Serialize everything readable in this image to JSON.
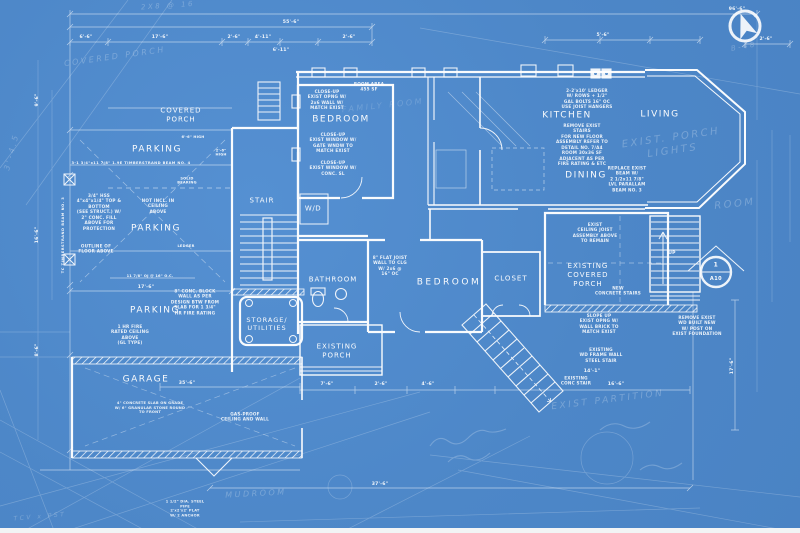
{
  "colors": {
    "background": "#4d87c8",
    "ink": "#ffffff"
  },
  "rooms": {
    "covered_porch": "COVERED\nPORCH",
    "parking_upper": "PARKING",
    "parking_middle": "PARKING",
    "parking_lower": "PARKING",
    "stair": "STAIR",
    "washer_dryer": "W/D",
    "bedroom_upper": "BEDROOM",
    "kitchen": "KITCHEN",
    "living": "LIVING",
    "dining": "DINING",
    "bathroom": "BATHROOM",
    "bedroom_main": "BEDROOM",
    "closet": "CLOSET",
    "existing_covered_porch": "EXISTING\nCOVERED\nPORCH",
    "existing_porch": "EXISTING\nPORCH",
    "storage_utilities": "STORAGE/\nUTILITIES",
    "garage": "GARAGE",
    "stair_up": "UP"
  },
  "callout": {
    "sheet_number": "1",
    "detail_ref": "A10"
  },
  "dims": {
    "top_total": "96'-6\"",
    "top_span": "55'-6\"",
    "seg_a": "6'-6\"",
    "seg_b": "17'-6\"",
    "seg_c": "2'-6\"",
    "seg_d": "4'-11\"",
    "seg_e": "6'-11\"",
    "seg_f": "2'-6\"",
    "right_a": "5'-6\"",
    "right_b": "2'-6\"",
    "left_a": "9'-6\"",
    "left_b": "16'-6\"",
    "left_c": "8'-6\"",
    "parking_width": "17'-6\"",
    "joist_note": "11 7/8\" OJ @ 16\" O.C.",
    "ledger": "LEDGER",
    "height_a": "6'-6\" HIGH",
    "height_b": "2'-6\"\nHIGH",
    "solid_bearing": "SOLID\nBEARING",
    "beam_note": "3-1 3/4\"x11 7/8\" 1.9E TIMBERSTRAND BEAM NO. 4",
    "beam_vert": "TC TIMBERSTRAND BEAM NO. 3",
    "garage_width": "35'-6\"",
    "porch_a": "7'-6\"",
    "porch_b": "2'-6\"",
    "porch_c": "4'-6\"",
    "south_a": "14'-1\"",
    "south_b": "16'-6\"",
    "east_height": "17'-6\"",
    "bottom_total": "37'-6\""
  },
  "notes": {
    "bedroom_opening": "CLOSE-UP\nEXIST OPNG W/\n2x6 WALL W/\nMATCH EXIST",
    "room_area": "ROOM AREA\n455 SF",
    "bedroom_window_a": "CLOSE-UP\nEXIST WINDOW W/\nGATE WNDW TO\nMATCH EXIST",
    "bedroom_window_b": "CLOSE-UP\nEXIST WINDOW W/\nCONC. SL",
    "ledger_detail": "2-2'x10' LEDGER\nW/ ROWS + 1/2\"\nGAL BOLTS 16\" OC\nUSE JOIST HANGERS",
    "stair_removal": "REMOVE EXIST\nSTAIRS\nFOR NEW FLOOR\nASSEMBLY REFER TO\nDETAIL NO. 7/A4\nROOM 30x36 SF\nADJACENT AS PER\nFIRE RATING & ETC",
    "beam_replace": "REPLACE EXIST\nBEAM W/\n2 1/2x11 7/8\"\nLVL PARALLAM\nBEAM NO. 3",
    "hss_column": "3/4\" HSS\n4\"x4\"x1/4\" TOP &\nBOTTOM\n(SEE STRUCT.) W/\n2\" CONC. FILL\nABOVE FOR\nPROTECTION",
    "floor_outline": "OUTLINE OF\nFLOOR ABOVE",
    "ceiling_gap": "NOT INCL. IN\nCEILING\nABOVE",
    "fire_ceiling": "1 HR FIRE\nRATED CEILING\nABOVE\n(GL TYPE)",
    "block_wall": "8\" CONC. BLOCK\nWALL AS PER\nDESIGN BTW FROM\nSLAB FOR 1 3/4\"\nHR FIRE RATING",
    "garage_slab": "4\" CONCRETE SLAB ON GRADE\nW/ 6\" GRANULAR STONE ROUND\nTO FRONT",
    "gasproof": "GAS-PROOF\nCEILING AND WALL",
    "steel_pipe": "1 1/2\" DIA. STEEL\nPIPE\n2'x2'x2' PLAT\nW/ 2 ANCHOR",
    "ceiling_joist": "EXIST\nCEILING JOIST\nASSEMBLY ABOVE\nTO REMAIN",
    "concrete_stairs": "NEW\nCONCRETE STAIRS",
    "slope_up": "SLOPE UP\nEXIST OPNG W/\nWALL BRICK TO\nMATCH EXIST",
    "porch_post": "REMOVE EXIST\nWD BUILT NEW\nW/ POST ON\nEXIST FOUNDATION",
    "frame_wall": "EXISTING\nWD FRAME WALL\nSTEEL STAIR",
    "flat_joist": "8\" FLAT JOIST\nWALL TO CLG\nW/ 2x6 @\n16\" OC",
    "conc_stair": "EXISTING\nCONC STAIR"
  },
  "ghost": {
    "lumber": "2X8 @ 16",
    "covered_porch_sketch": "COVERED PORCH",
    "porch_lights": "EXIST. PORCH LIGHTS",
    "room_sketch": "ROOM",
    "family_room": "FAMILY ROOM",
    "mudroom": "MUDROOM",
    "partition": "EXIST PARTITION",
    "sheet_ref": "B-48",
    "left_dim": "3'-4.5",
    "post_sketch": "TCV x PST"
  }
}
